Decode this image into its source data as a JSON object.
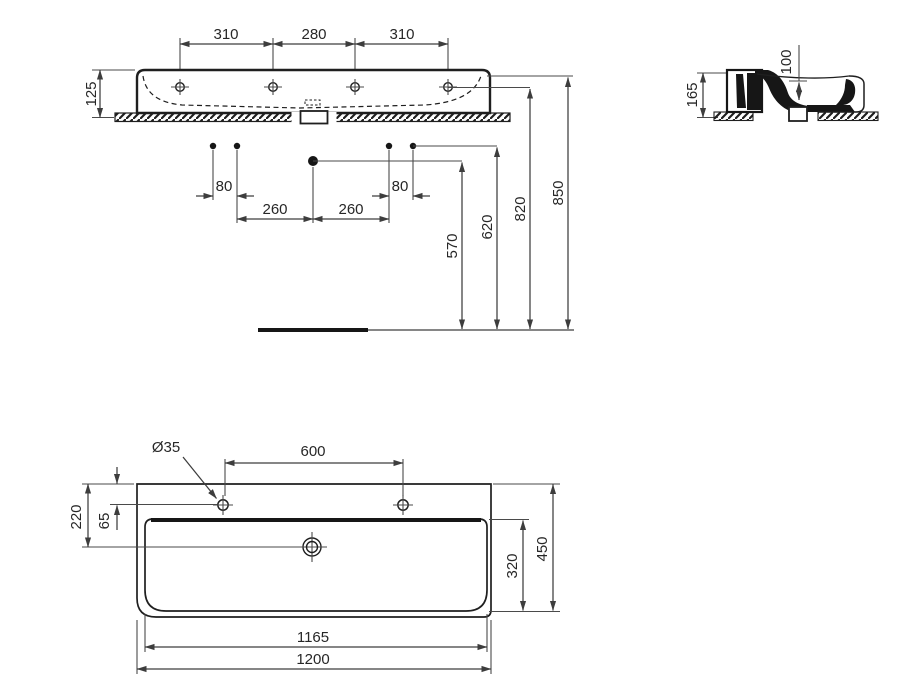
{
  "palette": {
    "background": "#ffffff",
    "ink": "#1f1f1f",
    "dimension_lines": "#3d3d3d",
    "text": "#272727"
  },
  "views": {
    "front": {
      "label": "front-elevation-with-installation-heights",
      "dims": {
        "tap_pitch_left": "310",
        "tap_pitch_mid": "280",
        "tap_pitch_right": "310",
        "apron_height": "125",
        "fix_pair_left": "80",
        "fix_pair_right": "80",
        "fix_pitch_left": "260",
        "fix_pitch_right": "260",
        "drain_height": "570",
        "fixing_height": "620",
        "taphole_height": "820",
        "rim_height": "850"
      }
    },
    "side": {
      "label": "side-section",
      "dims": {
        "total_height": "165",
        "bowl_depth": "100"
      }
    },
    "plan": {
      "label": "plan-view",
      "dims": {
        "taphole_diameter": "Ø35",
        "tap_centres": "600",
        "front_to_drain": "220",
        "rim_to_taphole": "65",
        "bowl_front_to_back": "320",
        "overall_depth": "450",
        "bowl_width": "1165",
        "overall_width": "1200"
      }
    }
  }
}
